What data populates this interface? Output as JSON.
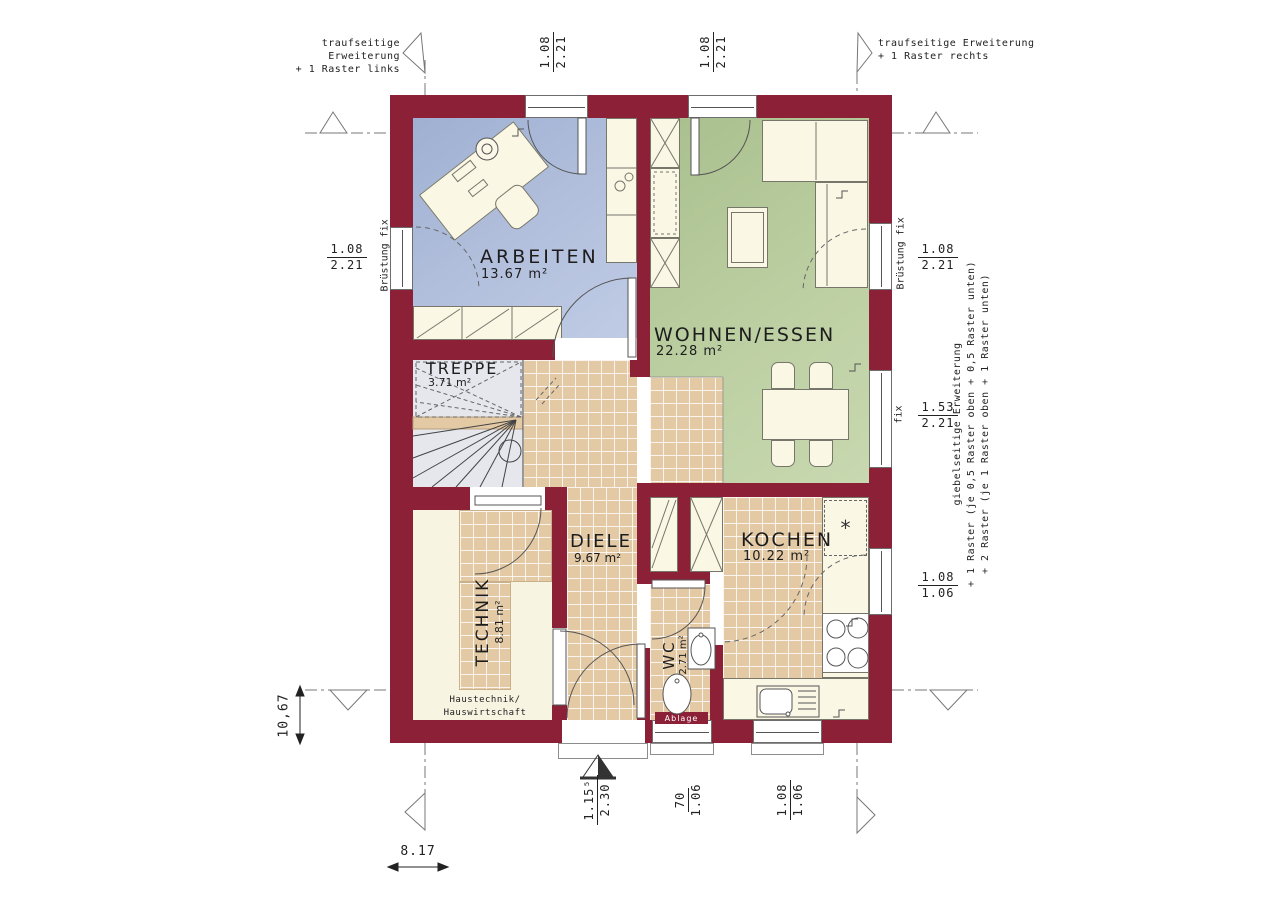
{
  "title": "Grundriss Erdgeschoss",
  "rooms": [
    {
      "name": "ARBEITEN",
      "area": "13.67 m²"
    },
    {
      "name": "WOHNEN/ESSEN",
      "area": "22.28 m²"
    },
    {
      "name": "TREPPE",
      "area": "3.71 m²"
    },
    {
      "name": "DIELE",
      "area": "9.67 m²"
    },
    {
      "name": "KOCHEN",
      "area": "10.22 m²"
    },
    {
      "name": "TECHNIK",
      "area": "8.81 m²"
    },
    {
      "name": "WC",
      "area": "2.71 m²"
    }
  ],
  "notes": {
    "top_left": {
      "line1": "traufseitige Erweiterung",
      "line2": "+ 1 Raster links"
    },
    "top_right": {
      "line1": "traufseitige Erweiterung",
      "line2": "+ 1 Raster rechts"
    },
    "giebel": {
      "line1": "giebelseitige Erweiterung",
      "line2": "+ 1 Raster (je 0,5 Raster oben + 0,5 Raster unten)",
      "line3": "+ 2 Raster (je 1 Raster oben + 1 Raster unten)"
    },
    "bruestung_left": "Brüstung fix",
    "bruestung_right": "Brüstung fix",
    "fix_right": "fix",
    "haustechnik": {
      "line1": "Haustechnik/",
      "line2": "Hauswirtschaft"
    },
    "ablage": "Ablage",
    "freezer_symbol": "*"
  },
  "dimensions": {
    "window_top_left": {
      "a": "1.08",
      "b": "2.21"
    },
    "window_top_right": {
      "a": "1.08",
      "b": "2.21"
    },
    "window_left": {
      "a": "1.08",
      "b": "2.21"
    },
    "window_right_upper": {
      "a": "1.08",
      "b": "2.21"
    },
    "window_right_mid": {
      "a": "1.53",
      "b": "2.21"
    },
    "window_right_lower": {
      "a": "1.08",
      "b": "1.06"
    },
    "entry_door": {
      "a": "1.15⁵",
      "b": "2.30"
    },
    "window_wc": {
      "a": "70",
      "b": "1.06"
    },
    "window_kitchen": {
      "a": "1.08",
      "b": "1.06"
    },
    "total_depth": "10,67",
    "total_width": "8.17"
  },
  "colors": {
    "wall": "#8c2037",
    "floor_arbeiten": "#aebbda",
    "floor_wohnen": "#bccfa3",
    "floor_tile": "#e3c9a4",
    "floor_treppe": "#e6e7ed",
    "floor_technik": "#f8f4e2",
    "furniture": "#faf7e4"
  }
}
